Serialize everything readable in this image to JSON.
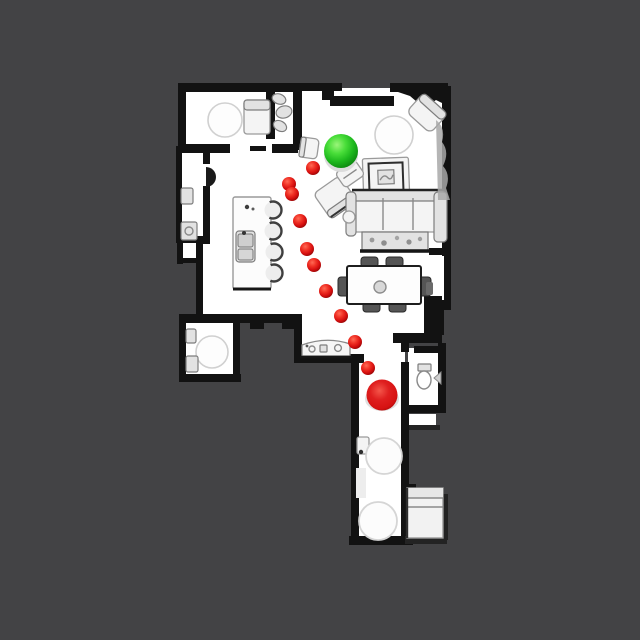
{
  "scene": {
    "view": "top-down-floorplan",
    "background_color": "#434345",
    "floor_color": "#ffffff",
    "wall_color": "#121212"
  },
  "markers": {
    "start": {
      "x": 341,
      "y": 151,
      "radius": 17,
      "color": "#1db81d",
      "highlight": "#9bf57a",
      "edge": "#0a5c0c",
      "shadow_color": "#dcdcdc"
    },
    "goal": {
      "x": 382,
      "y": 395,
      "radius": 15.5,
      "color": "#d61212",
      "highlight": "#f4564a",
      "edge": "#860404",
      "shadow_color": "#e0e0e0"
    },
    "waypoints": {
      "radius": 7,
      "color": "#d60f0f",
      "highlight": "#ff6a55",
      "edge": "#7c0303",
      "points": [
        {
          "x": 313,
          "y": 168
        },
        {
          "x": 289,
          "y": 184
        },
        {
          "x": 292,
          "y": 194
        },
        {
          "x": 300,
          "y": 221
        },
        {
          "x": 307,
          "y": 249
        },
        {
          "x": 314,
          "y": 265
        },
        {
          "x": 326,
          "y": 291
        },
        {
          "x": 341,
          "y": 316
        },
        {
          "x": 355,
          "y": 342
        },
        {
          "x": 368,
          "y": 368
        }
      ]
    }
  }
}
